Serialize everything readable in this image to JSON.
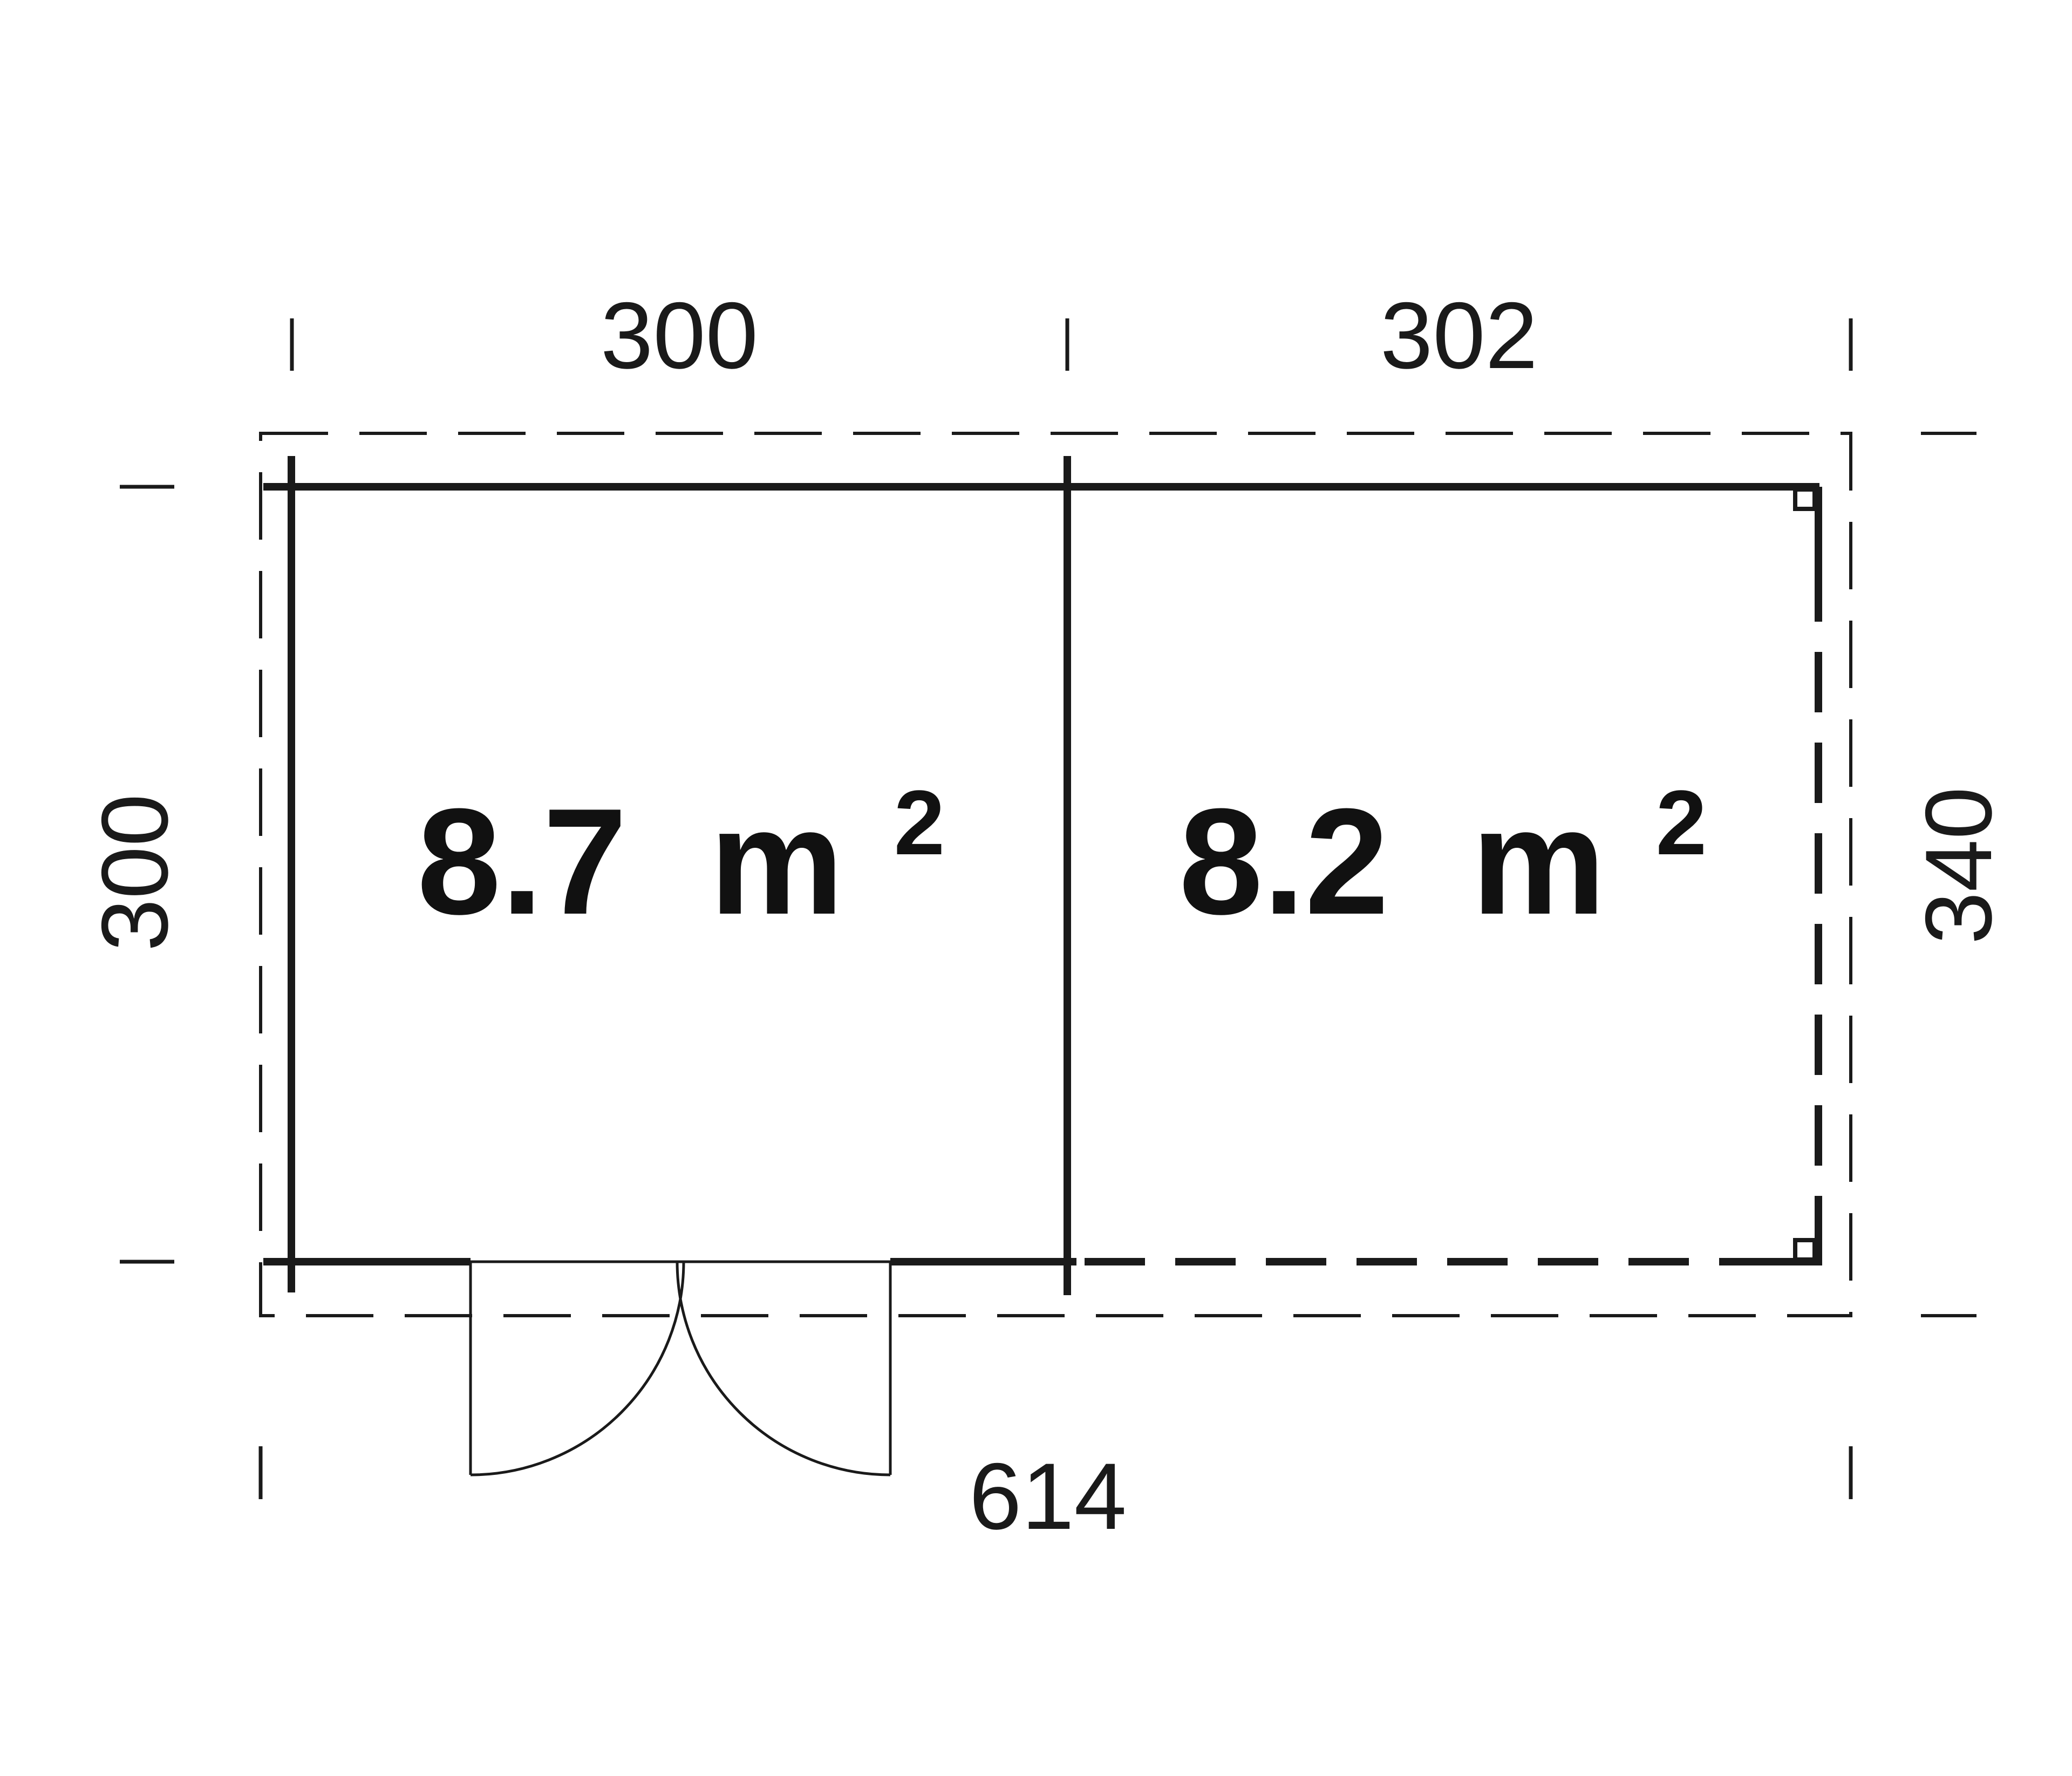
{
  "drawing": {
    "type": "shed-floor-plan",
    "colors": {
      "line": "#1a1a1a",
      "background": "#ffffff"
    }
  },
  "dimensions": {
    "top_left_width": "300",
    "top_right_width": "302",
    "left_depth": "300",
    "right_depth": "340",
    "total_width": "614"
  },
  "rooms": [
    {
      "id": "left-room",
      "area_value": "8.7",
      "area_unit": "m",
      "area_exponent": "2"
    },
    {
      "id": "right-room",
      "area_value": "8.2",
      "area_unit": "m",
      "area_exponent": "2"
    }
  ]
}
